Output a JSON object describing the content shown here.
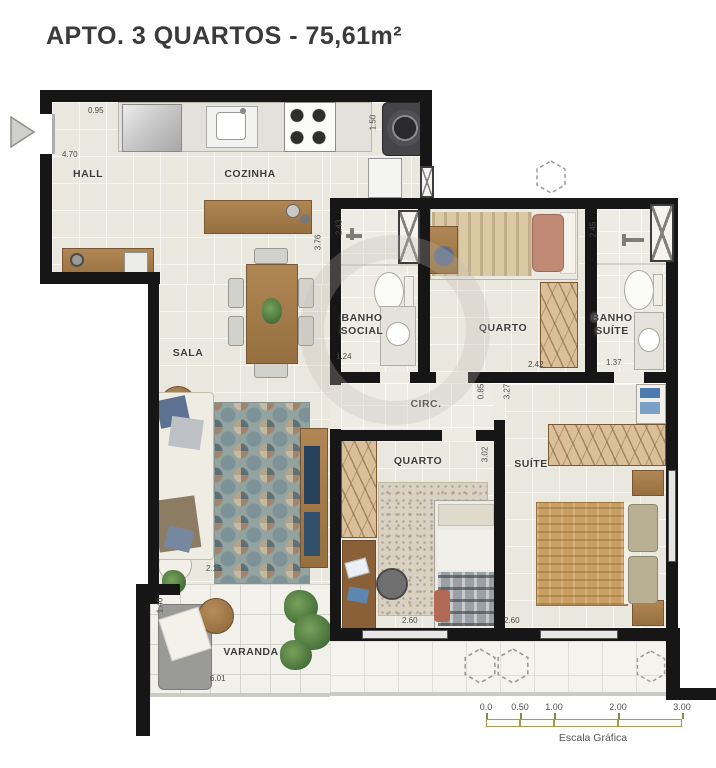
{
  "title": "APTO. 3 QUARTOS - 75,61m²",
  "rooms": {
    "hall": "HALL",
    "cozinha": "COZINHA",
    "sala": "SALA",
    "banho_social": "BANHO SOCIAL",
    "quarto_superior": "QUARTO",
    "banho_suite": "BANHO SUÍTE",
    "circulacao": "CIRC.",
    "quarto_inferior": "QUARTO",
    "suite": "SUÍTE",
    "varanda": "VARANDA"
  },
  "dimensions": {
    "hall_entrada": "0.95",
    "cozinha_largura": "4.70",
    "area_servico": "1.50",
    "banho_social_altura": "2.43",
    "sala_cozinha_altura": "3.76",
    "banho_social_largura": "1.24",
    "quarto_superior_largura": "2.42",
    "banho_suite_largura": "1.37",
    "banho_suite_altura": "2.45",
    "circulacao_altura": "0.85",
    "suite_altura": "3.27",
    "quarto_inferior_altura": "3.02",
    "sala_largura": "2.15",
    "varanda_altura": "1.40",
    "quarto_inferior_largura": "2.60",
    "suite_largura": "2.60",
    "varanda_largura": "6.01"
  },
  "scale_bar": {
    "ticks": [
      "0.0",
      "0.50",
      "1.00",
      "2.00",
      "3.00"
    ],
    "caption": "Escala Gráfica"
  },
  "colors": {
    "wall": "#161616",
    "floor": "#eae7de",
    "wood": "#a8804f",
    "scale_accent": "#a39a58",
    "title_text": "#3a3a3a"
  }
}
